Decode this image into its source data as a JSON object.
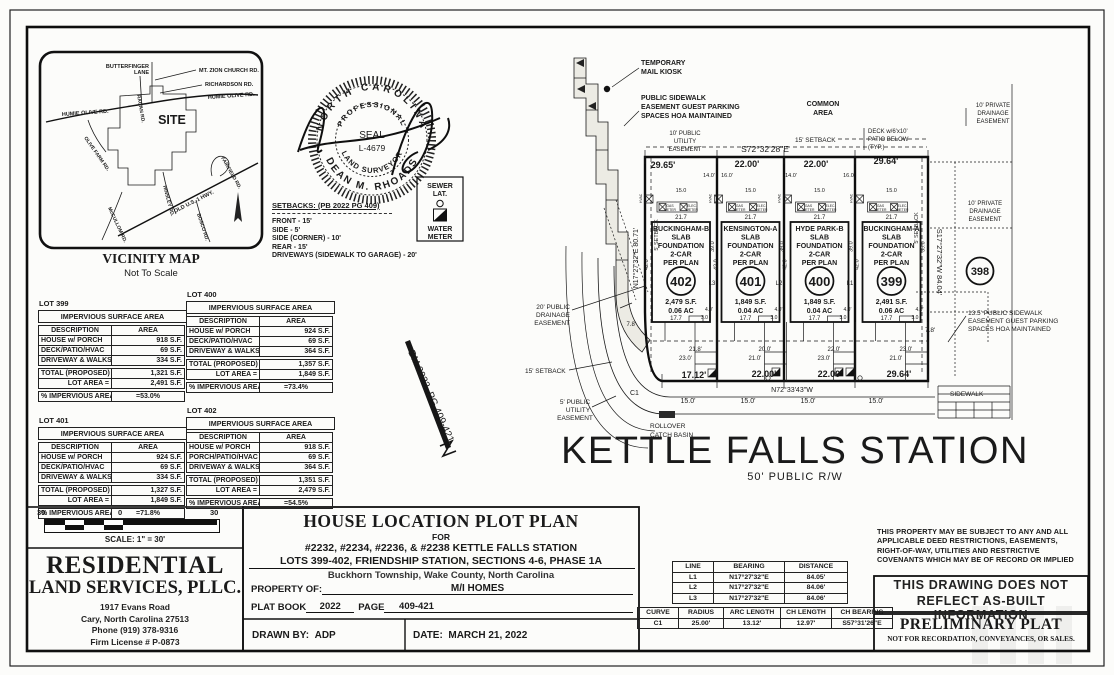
{
  "vicinity": {
    "title": "VICINITY MAP",
    "subtitle": "Not To Scale",
    "site_label": "SITE",
    "road_butterfinger_1": "BUTTERFINGER",
    "road_butterfinger_2": "LANE",
    "road_mt_zion": "MT. ZION CHURCH RD.",
    "road_richardson": "RICHARDSON RD.",
    "road_humie_w": "HUMIE OLIVE RD.",
    "road_humie_e": "HUMIE OLIVE RD.",
    "road_ragan": "RAGAN RD.",
    "road_olive_farm": "OLIVE FARM RD.",
    "road_hinsley": "HINSLEY RD.",
    "road_fairfield": "FAIRFIELD RD.",
    "road_old_us1": "OLD U.S. 1 HWY.",
    "road_bosco": "BOSCO RD.",
    "road_mccullom": "McCULLOM RD."
  },
  "seal": {
    "arc_top": "NORTH CAROLINA",
    "arc_inner_top": "PROFESSIONAL",
    "center1": "SEAL",
    "center2": "L-4679",
    "arc_inner_bottom": "LAND SURVEYOR",
    "arc_bottom": "DEAN M. RHOADS"
  },
  "setbacks": {
    "heading": "SETBACKS: (PB 2022 PG 409)",
    "lines": [
      "FRONT - 15'",
      "SIDE - 5'",
      "SIDE (CORNER) - 10'",
      "REAR - 15'",
      "DRIVEWAYS (SIDEWALK TO GARAGE) - 20'"
    ]
  },
  "legend": {
    "l1": "SEWER",
    "l2": "LAT.",
    "l3": "WATER",
    "l4": "METER"
  },
  "benchmark": "BM 2022, PG 409-421",
  "impervious_tables": [
    {
      "lot": "LOT 399",
      "title": "IMPERVIOUS SURFACE AREA",
      "headers": [
        "DESCRIPTION",
        "AREA"
      ],
      "rows": [
        [
          "HOUSE w/ PORCH",
          "918 S.F."
        ],
        [
          "DECK/PATIO/HVAC",
          "69 S.F."
        ],
        [
          "DRIVEWAY & WALKS",
          "334 S.F."
        ],
        [
          "TOTAL (PROPOSED) =",
          "1,321 S.F."
        ],
        [
          "LOT AREA =",
          "2,491 S.F."
        ],
        [
          "% IMPERVIOUS AREA",
          "=53.0%"
        ]
      ]
    },
    {
      "lot": "LOT 400",
      "title": "IMPERVIOUS SURFACE AREA",
      "headers": [
        "DESCRIPTION",
        "AREA"
      ],
      "rows": [
        [
          "HOUSE w/ PORCH",
          "924 S.F."
        ],
        [
          "DECK/PATIO/HVAC",
          "69 S.F."
        ],
        [
          "DRIVEWAY & WALKS",
          "364 S.F."
        ],
        [
          "TOTAL (PROPOSED) =",
          "1,357 S.F."
        ],
        [
          "LOT AREA =",
          "1,849 S.F."
        ],
        [
          "% IMPERVIOUS AREA",
          "=73.4%"
        ]
      ]
    },
    {
      "lot": "LOT 401",
      "title": "IMPERVIOUS SURFACE AREA",
      "headers": [
        "DESCRIPTION",
        "AREA"
      ],
      "rows": [
        [
          "HOUSE w/ PORCH",
          "924 S.F."
        ],
        [
          "DECK/PATIO/HVAC",
          "69 S.F."
        ],
        [
          "DRIVEWAY & WALKS",
          "334 S.F."
        ],
        [
          "TOTAL (PROPOSED) =",
          "1,327 S.F."
        ],
        [
          "LOT AREA =",
          "1,849 S.F."
        ],
        [
          "% IMPERVIOUS AREA",
          "=71.8%"
        ]
      ]
    },
    {
      "lot": "LOT 402",
      "title": "IMPERVIOUS SURFACE AREA",
      "headers": [
        "DESCRIPTION",
        "AREA"
      ],
      "rows": [
        [
          "HOUSE w/ PORCH",
          "918 S.F."
        ],
        [
          "PORCH/PATIO/HVAC",
          "69 S.F."
        ],
        [
          "DRIVEWAY & WALKS",
          "364 S.F."
        ],
        [
          "TOTAL (PROPOSED) =",
          "1,351 S.F."
        ],
        [
          "LOT AREA =",
          "2,479 S.F."
        ],
        [
          "% IMPERVIOUS AREA",
          "=54.5%"
        ]
      ]
    }
  ],
  "plat": {
    "street_name": "KETTLE FALLS STATION",
    "street_sub": "50'  PUBLIC  R/W",
    "bearing_top": "S72°32'28\"E",
    "bearing_bottom": "N72°33'43\"W",
    "bearing_left": "N17°27'32\"E  80.71'",
    "bearing_right": "S17°27'32\"W  84.04'",
    "adjacent_lot": "398",
    "curve_label": "C1",
    "top_dims": [
      "29.65'",
      "22.00'",
      "22.00'",
      "29.64'"
    ],
    "small_dims": [
      "14.0'",
      "16.0'",
      "14.0'",
      "16.0'"
    ],
    "front_dims": [
      "17.12'",
      "22.00'",
      "22.00'",
      "29.64'"
    ],
    "drive_dims": [
      "15.0'",
      "15.0'",
      "15.0'",
      "15.0'"
    ],
    "lot_line_labels": [
      "L3",
      "L2",
      "L1"
    ],
    "house_dims": {
      "w15": "15.0",
      "top": "21.7",
      "bot": "17.7",
      "left": "42.0",
      "right": "39.0",
      "d4": "4.0'",
      "d3": "3.0"
    },
    "meters": {
      "gas": "GAS",
      "elec": "ELEC.",
      "meter": "METER",
      "hvac": "HVAC"
    },
    "lots": [
      {
        "num": "402",
        "name": [
          "BUCKINGHAM-B",
          "SLAB",
          "FOUNDATION",
          "2-CAR",
          "PER PLAN"
        ],
        "area": "2,479 S.F.",
        "ac": "0.06 AC",
        "d1": "21.8'",
        "d2": "23.0'"
      },
      {
        "num": "401",
        "name": [
          "KENSINGTON-A",
          "SLAB",
          "FOUNDATION",
          "2-CAR",
          "PER PLAN"
        ],
        "area": "1,849 S.F.",
        "ac": "0.04 AC",
        "d1": "20.0'",
        "d2": "21.0'"
      },
      {
        "num": "400",
        "name": [
          "HYDE PARK-B",
          "SLAB",
          "FOUNDATION",
          "2-CAR",
          "PER PLAN"
        ],
        "area": "1,849 S.F.",
        "ac": "0.04 AC",
        "d1": "22.0'",
        "d2": "23.0'"
      },
      {
        "num": "399",
        "name": [
          "BUCKINGHAM-A",
          "SLAB",
          "FOUNDATION",
          "2-CAR",
          "PER PLAN"
        ],
        "area": "2,491 S.F.",
        "ac": "0.06 AC",
        "d1": "23.0'",
        "d2": "21.0'"
      }
    ],
    "notes": {
      "kiosk1": "TEMPORARY",
      "kiosk2": "MAIL KIOSK",
      "guest1": "PUBLIC SIDEWALK",
      "guest2": "EASEMENT GUEST PARKING",
      "guest3": "SPACES HOA MAINTAINED",
      "common1": "COMMON",
      "common2": "AREA",
      "pue10_1": "10' PUBLIC",
      "pue10_2": "UTILITY",
      "pue10_3": "EASEMENT",
      "setback15_top": "15' SETBACK",
      "setback15_left": "15' SETBACK",
      "setback5_left": "5' SETBACK",
      "setback5_right": "5' SETBACK",
      "deck1": "DECK w/6'x10'",
      "deck2": "PATIO BELOW",
      "deck3": "(TYP.)",
      "pde10a_1": "10' PRIVATE",
      "pde10a_2": "DRAINAGE",
      "pde10a_3": "EASEMENT",
      "pde10b_1": "10' PRIVATE",
      "pde10b_2": "DRAINAGE",
      "pde10b_3": "EASEMENT",
      "pde20_1": "20' PUBLIC",
      "pde20_2": "DRAINAGE",
      "pde20_3": "EASEMENT",
      "pue5_1": "5' PUBLIC",
      "pue5_2": "UTILITY",
      "pue5_3": "EASEMENT",
      "swe1": "13.5' PUBLIC SIDEWALK",
      "swe2": "EASEMENT GUEST PARKING",
      "swe3": "SPACES HOA MAINTAINED",
      "sidewalk": "SIDEWALK",
      "basin1": "ROLLOVER",
      "basin2": "CATCH BASIN",
      "d78_left": "7.8'",
      "d78_right": "7.8'"
    }
  },
  "title_block": {
    "title": "HOUSE LOCATION PLOT PLAN",
    "for_label": "FOR",
    "line1": "#2232, #2234, #2236, & #2238 KETTLE FALLS STATION",
    "line2": "LOTS 399-402, FRIENDSHIP STATION, SECTIONS 4-6, PHASE 1A",
    "line3": "Buckhorn Township, Wake County, North Carolina",
    "property_label": "PROPERTY OF:",
    "property_value": "M/I HOMES",
    "plat_book_label": "PLAT BOOK",
    "plat_book_value": "2022",
    "page_label": "PAGE",
    "page_value": "409-421",
    "drawn_by_label": "DRAWN BY:",
    "drawn_by_value": "ADP",
    "date_label": "DATE:",
    "date_value": "MARCH 21, 2022"
  },
  "firm": {
    "name1": "RESIDENTIAL",
    "name2": "LAND SERVICES, PLLC.",
    "addr1": "1917 Evans Road",
    "addr2": "Cary, North Carolina 27513",
    "addr3": "Phone (919) 378-9316",
    "addr4": "Firm License # P-0873"
  },
  "scale": {
    "left": "30",
    "zero": "0",
    "right": "30",
    "caption": "SCALE: 1\" = 30'"
  },
  "line_table": {
    "headers": [
      "LINE",
      "BEARING",
      "DISTANCE"
    ],
    "rows": [
      [
        "L1",
        "N17°27'32\"E",
        "84.05'"
      ],
      [
        "L2",
        "N17°27'32\"E",
        "84.06'"
      ],
      [
        "L3",
        "N17°27'32\"E",
        "84.06'"
      ]
    ]
  },
  "curve_table": {
    "headers": [
      "CURVE",
      "RADIUS",
      "ARC LENGTH",
      "CH LENGTH",
      "CH BEARING"
    ],
    "rows": [
      [
        "C1",
        "25.00'",
        "13.12'",
        "12.97'",
        "S57°31'26\"E"
      ]
    ]
  },
  "disclaimers": {
    "deed1": "THIS PROPERTY MAY BE SUBJECT TO ANY AND ALL",
    "deed2": "APPLICABLE DEED RESTRICTIONS, EASEMENTS,",
    "deed3": "RIGHT-OF-WAY, UTILITIES AND RESTRICTIVE",
    "deed4": "COVENANTS WHICH MAY BE OF RECORD OR IMPLIED",
    "asbuilt1": "THIS DRAWING DOES NOT",
    "asbuilt2": "REFLECT AS-BUILT INFORMATION",
    "prelim_title": "PRELIMINARY PLAT",
    "prelim_sub": "NOT FOR RECORDATION, CONVEYANCES, OR SALES."
  }
}
